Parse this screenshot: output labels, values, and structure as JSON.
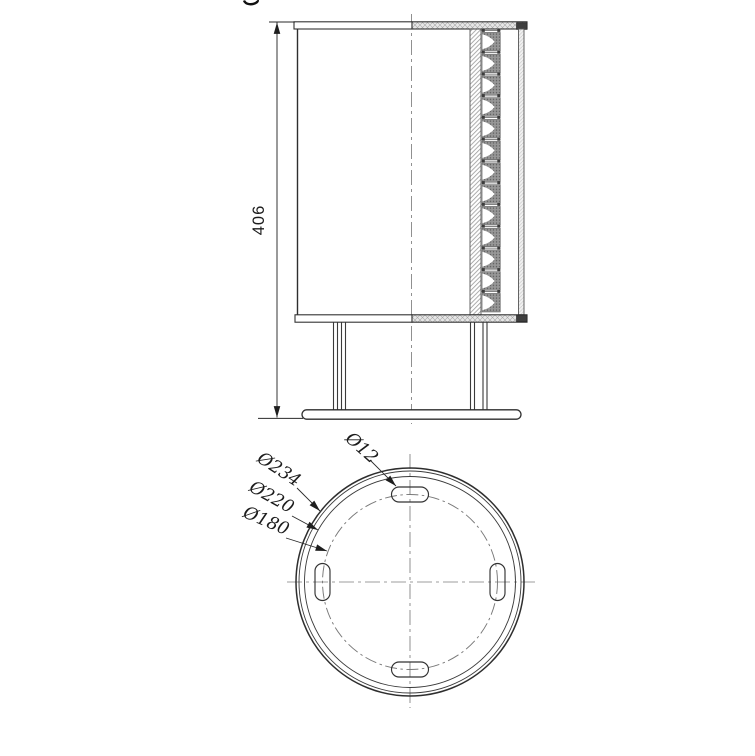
{
  "side_view": {
    "height_dim": "406",
    "reflector_count": 13
  },
  "bottom_view": {
    "dim_slot": "Ø12",
    "dim_outer": "Ø234",
    "dim_mid": "Ø220",
    "dim_bolt": "Ø180",
    "slot_count": 4
  },
  "colors": {
    "line": "#2e2e2e",
    "centerline": "#7d7d7d",
    "hatch_line": "#8c8c8c",
    "cap_fill": "#e7e7e7",
    "reflector_fill": "#979797",
    "seal_fill": "#3f3f3f",
    "background": "#ffffff"
  }
}
